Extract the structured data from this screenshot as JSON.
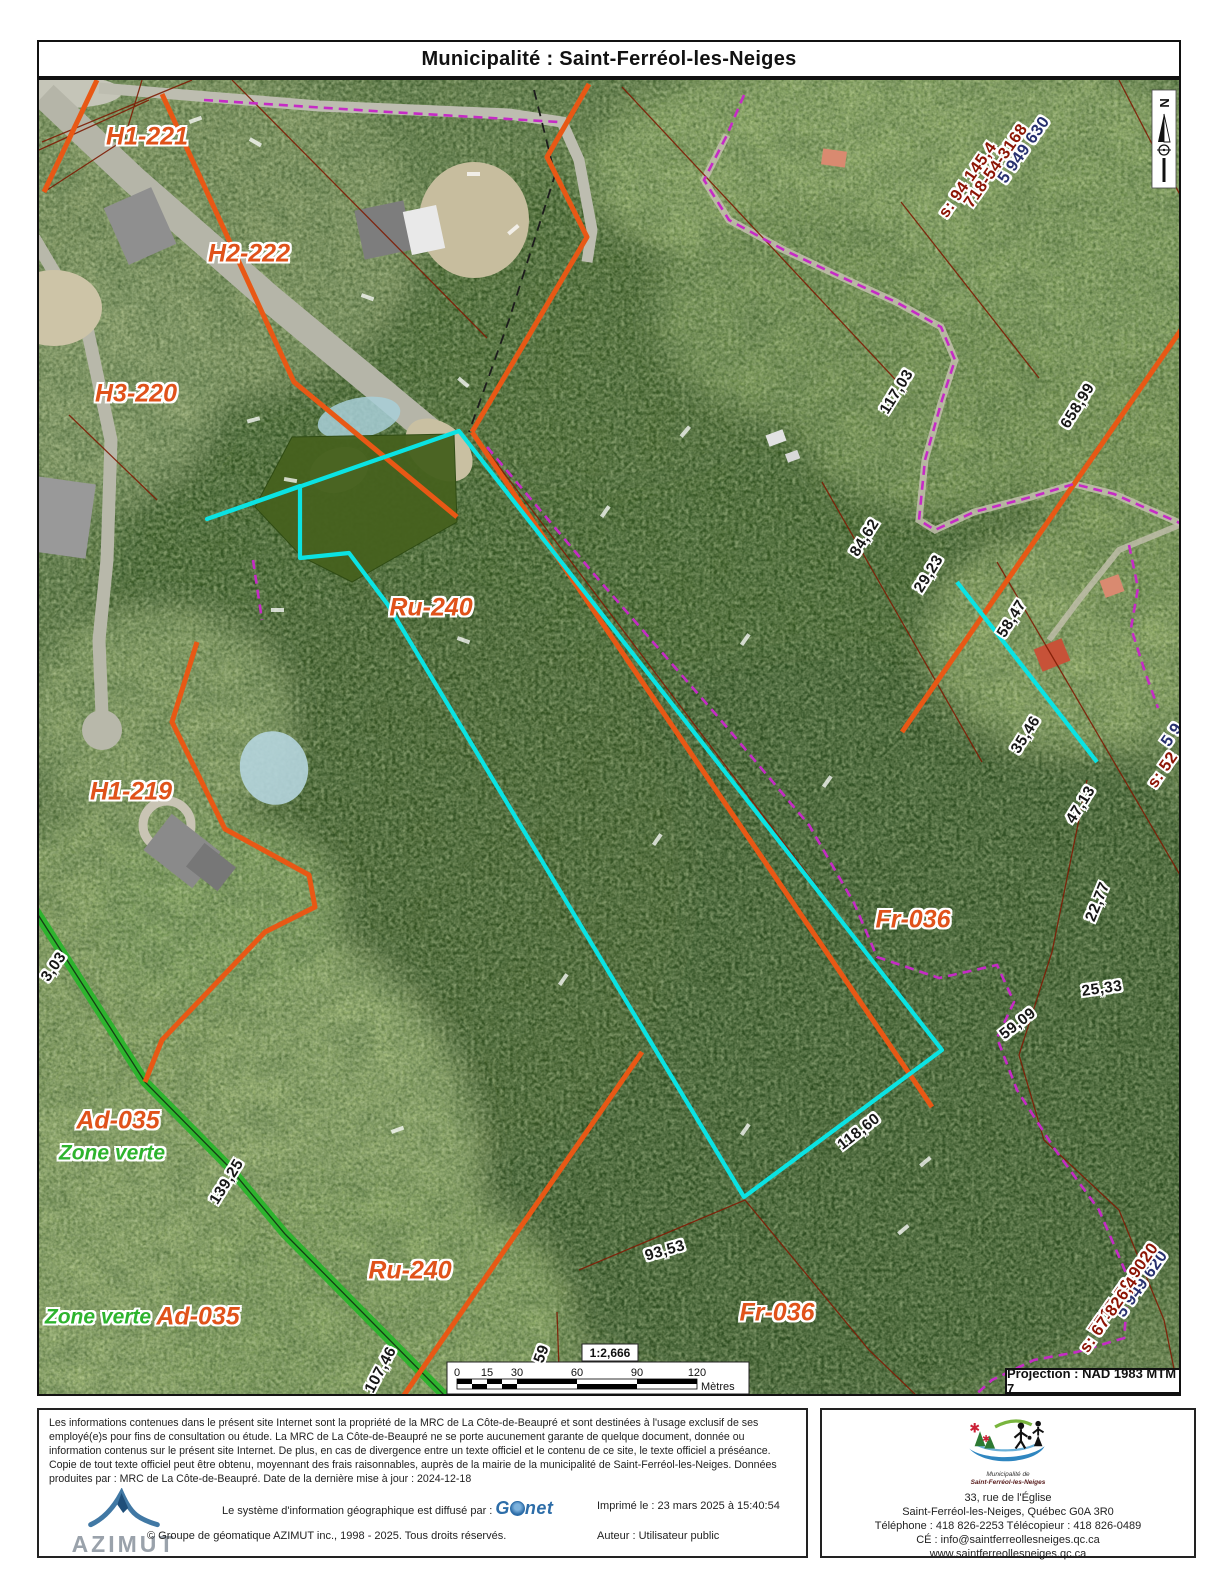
{
  "title": "Municipalité : Saint-Ferréol-les-Neiges",
  "map": {
    "zones": {
      "h1_221": "H1-221",
      "h2_222": "H2-222",
      "h3_220": "H3-220",
      "ru_240": "Ru-240",
      "h1_219": "H1-219",
      "fr_036": "Fr-036",
      "ad_035": "Ad-035",
      "zone_verte": "Zone verte",
      "ru_240_b": "Ru-240",
      "fr_036_b": "Fr-036",
      "ad_035_b": "Ad-035",
      "zone_verte_b": "Zone verte"
    },
    "measurements": {
      "m117_03": "117,03",
      "m658_99": "658,99",
      "m84_62": "84,62",
      "m29_23": "29,23",
      "m58_47": "58,47",
      "m35_46": "35,46",
      "m47_13": "47,13",
      "m22_77": "22,77",
      "m25_33": "25,33",
      "m59_09": "59,09",
      "m118_60": "118,60",
      "m93_53": "93,53",
      "m139_25": "139,25",
      "m107_46": "107,46",
      "m3_03": "3,03",
      "m59": "59"
    },
    "lot_numbers": {
      "top_blue": "5 949 630",
      "top_lot": "718-54-3168",
      "top_s": "s: 94 145,4",
      "bottom_blue": "5 949 620",
      "bottom_lot": "7717-59-9020",
      "bottom_s": "s: 67 826,4",
      "edge_blue": "5 9",
      "edge_s": "s: 52"
    },
    "north": "N",
    "scale": {
      "ratio": "1:2,666",
      "t0": "0",
      "t15": "15",
      "t30": "30",
      "t60": "60",
      "t90": "90",
      "t120": "120",
      "unit": "Mètres"
    },
    "projection": "Projection : NAD 1983 MTM 7",
    "colors": {
      "zone_label_orange": "#e0521a",
      "zone_boundary_orange": "#e85815",
      "highlight_cyan": "#0be3e3",
      "dashed_magenta": "#c52bc5",
      "zone_verte_green": "#2eb32e",
      "parcel_dark_red": "#7e1c04",
      "lot_navy": "#27306f",
      "lot_dark_red": "#8c1404"
    }
  },
  "footer": {
    "disclaimer": "Les informations contenues dans le présent site Internet sont la propriété de la MRC de La Côte-de-Beaupré et sont destinées à l'usage exclusif de ses employé(e)s pour fins de consultation ou étude. La MRC de La Côte-de-Beaupré ne se porte aucunement garante de quelque document, donnée ou information contenus sur le présent site Internet. De plus, en cas de divergence entre un texte officiel et le contenu de ce site, le texte officiel a préséance. Copie de tout texte officiel peut être obtenu, moyennant des frais raisonnables, auprès de la mairie de la municipalité de Saint-Ferréol-les-Neiges. Données produites par : MRC de La Côte-de-Beaupré. Date de la dernière mise à jour : 2024-12-18",
    "azimut_label": "AZIMUT",
    "diffusion_prefix": "Le système d'information géographique est diffusé par :",
    "gonet_g": "G",
    "gonet_net": "net",
    "printed_label": "Imprimé le : 23 mars 2025 à 15:40:54",
    "copyright": "© Groupe de géomatique AZIMUT inc., 1998 - 2025. Tous droits réservés.",
    "author_label": "Auteur : Utilisateur public",
    "municipality": {
      "caption1": "Municipalité de",
      "caption2": "Saint-Ferréol-les-Neiges",
      "addr1": "33, rue de l'Église",
      "addr2": "Saint-Ferréol-les-Neiges, Québec G0A 3R0",
      "addr3": "Téléphone : 418  826-2253 Télécopieur : 418  826-0489",
      "addr4": "CÉ : info@saintferreollesneiges.qc.ca",
      "addr5": "www.saintferreollesneiges.qc.ca"
    }
  }
}
